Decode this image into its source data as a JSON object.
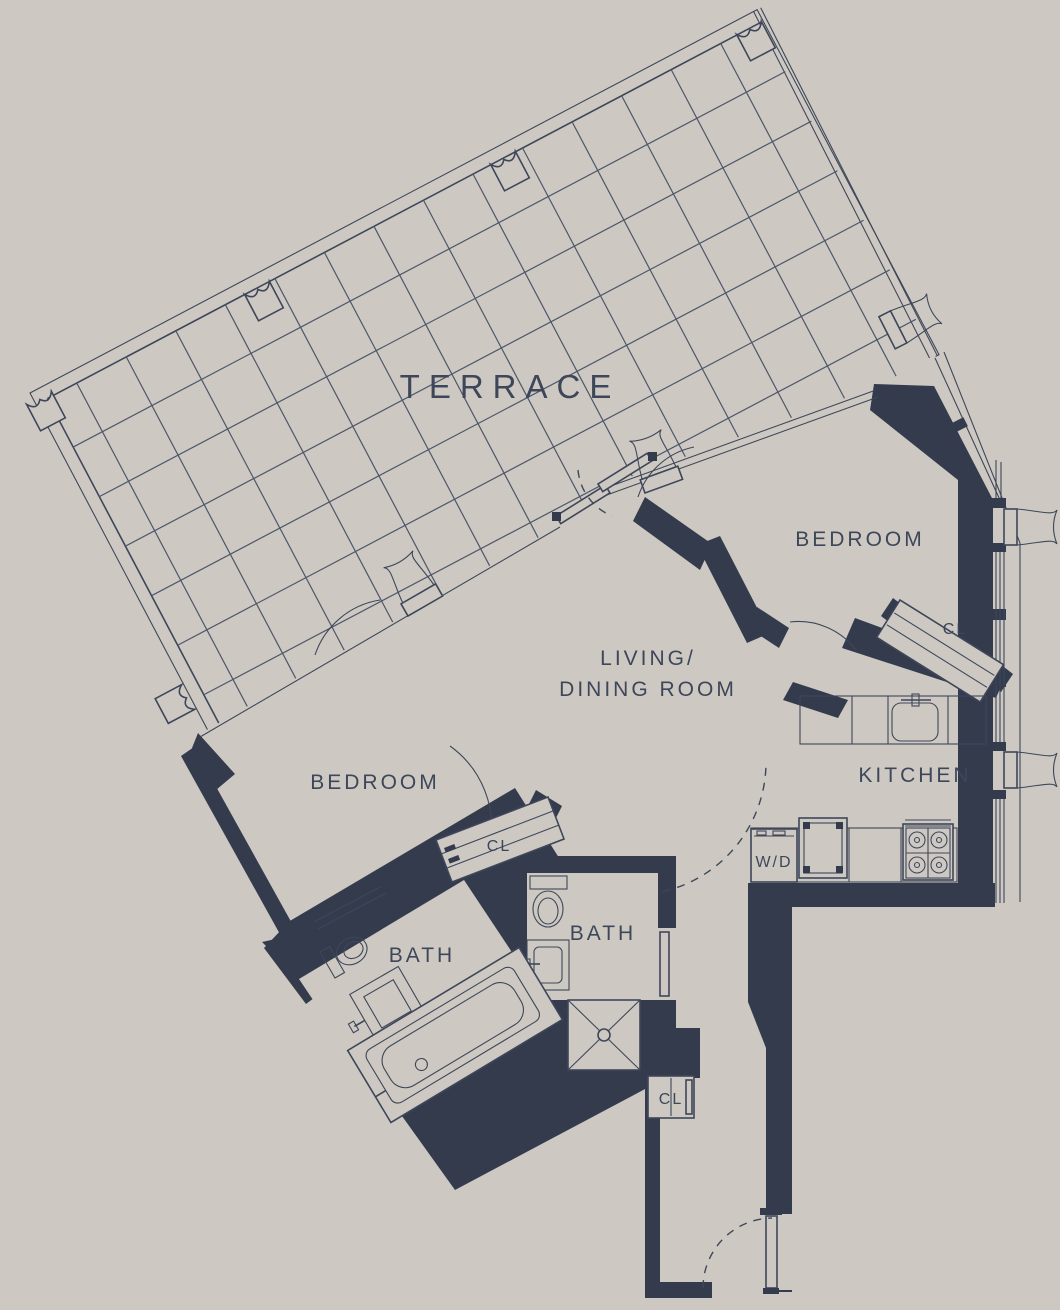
{
  "title": "Residential floor plan",
  "colors": {
    "background": "#cdc9c2",
    "wall": "#333b4d",
    "line": "#3e4759",
    "grid": "#4d566a",
    "text": "#3d4759"
  },
  "labels": {
    "terrace": "TERRACE",
    "bedroom_right": "BEDROOM",
    "bedroom_left": "BEDROOM",
    "living_line1": "LIVING/",
    "living_line2": "DINING ROOM",
    "kitchen": "KITCHEN",
    "bath_left": "BATH",
    "bath_right": "BATH",
    "cl_bedroom_right": "CL",
    "cl_bedroom_left": "CL",
    "cl_hall": "CL",
    "wd": "W/D"
  }
}
